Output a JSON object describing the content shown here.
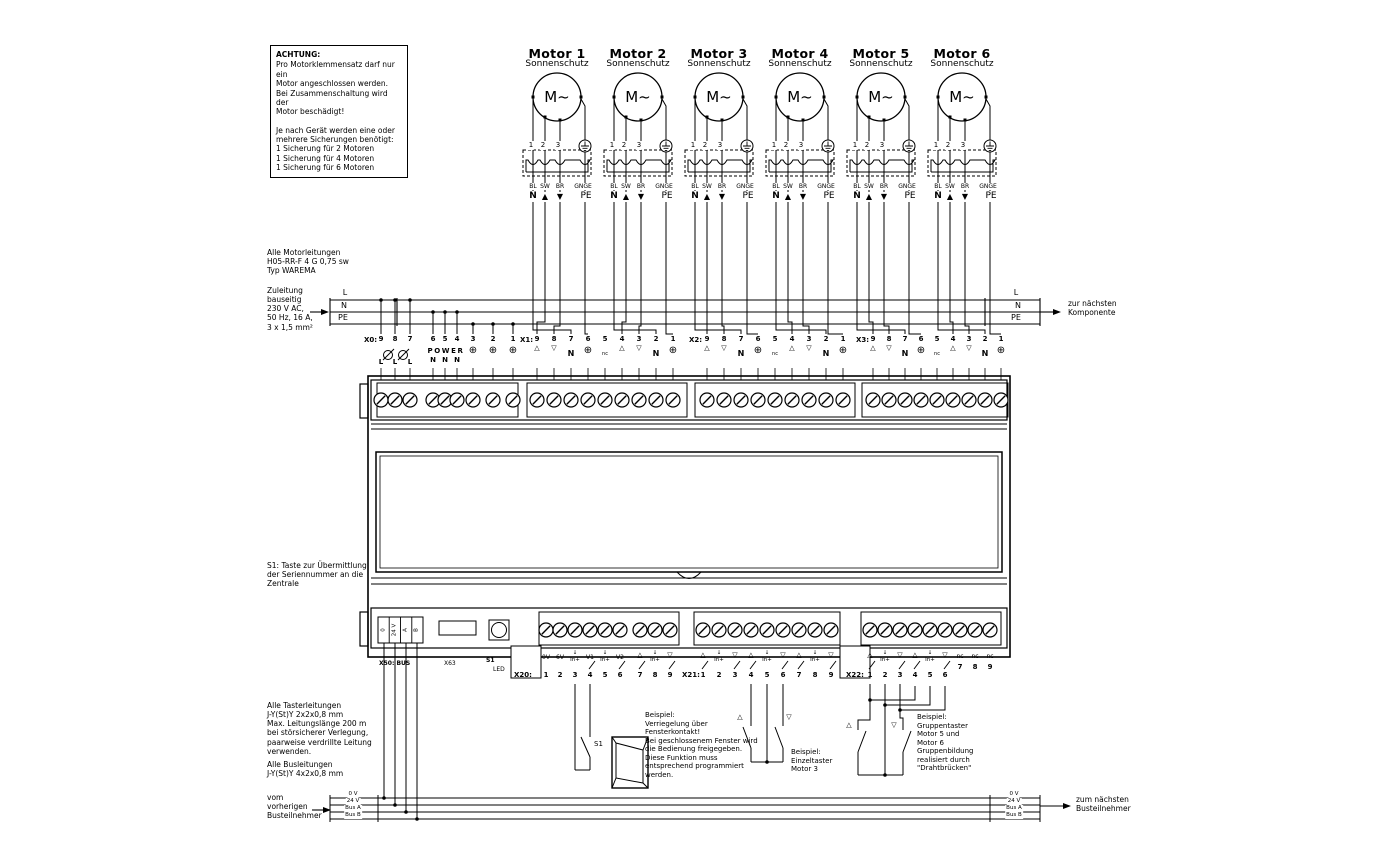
{
  "warning": {
    "title": "ACHTUNG:",
    "body1": "Pro Motorklemmensatz darf nur ein\nMotor angeschlossen werden.\nBei Zusammenschaltung wird der\nMotor beschädigt!",
    "body2": "Je nach Gerät werden eine oder\nmehrere Sicherungen benötigt:\n1 Sicherung für 2 Motoren\n1 Sicherung für 4 Motoren\n1 Sicherung für 6 Motoren"
  },
  "motors": [
    {
      "name": "Motor 1",
      "subtitle": "Sonnenschutz",
      "symbol": "M~"
    },
    {
      "name": "Motor 2",
      "subtitle": "Sonnenschutz",
      "symbol": "M~"
    },
    {
      "name": "Motor 3",
      "subtitle": "Sonnenschutz",
      "symbol": "M~"
    },
    {
      "name": "Motor 4",
      "subtitle": "Sonnenschutz",
      "symbol": "M~"
    },
    {
      "name": "Motor 5",
      "subtitle": "Sonnenschutz",
      "symbol": "M~"
    },
    {
      "name": "Motor 6",
      "subtitle": "Sonnenschutz",
      "symbol": "M~"
    }
  ],
  "motor_terminal": {
    "t1": "1",
    "t2": "2",
    "t3": "3",
    "colors": [
      "BL",
      "SW",
      "BR"
    ],
    "pe_color": "GNGE",
    "n": "N",
    "up": "▲",
    "down": "▼",
    "pe": "PE"
  },
  "notes": {
    "motor_cables": "Alle Motorleitungen\nH05-RR-F 4 G 0,75 sw\nTyp WAREMA",
    "supply": "Zuleitung\nbauseitig\n230 V AC,\n50 Hz, 16 A,\n3 x 1,5 mm²",
    "s1_note": "S1: Taste zur Übermittlung\nder Seriennummer an die\nZentrale",
    "taster_cables": "Alle Tasterleitungen\nJ-Y(St)Y 2x2x0,8 mm\nMax. Leitungslänge 200 m\nbei störsicherer Verlegung,\npaarweise verdrillte Leitung\nverwenden.",
    "bus_cables": "Alle Busleitungen\nJ-Y(St)Y 4x2x0,8 mm",
    "from_prev": "vom\nvorherigen\nBusteilnehmer",
    "next_component": "zur nächsten\nKomponente",
    "next_bus": "zum nächsten\nBusteilnehmer"
  },
  "power_bus": {
    "l": "L",
    "n": "N",
    "pe": "PE"
  },
  "data_bus": {
    "labels": [
      "0 V",
      "24 V",
      "Bus A",
      "Bus B"
    ]
  },
  "device": {
    "x0": {
      "label": "X0:",
      "nums": [
        "9",
        "8",
        "7",
        "6",
        "5",
        "4",
        "3",
        "2",
        "1"
      ],
      "l": "L",
      "power": "POWER",
      "n": "N",
      "pe": "⊕"
    },
    "x1": {
      "label": "X1:",
      "nums": [
        "9",
        "8",
        "7",
        "6",
        "5",
        "4",
        "3",
        "2",
        "1"
      ],
      "sym": [
        "△",
        "▽",
        "N",
        "⊕",
        "nc",
        "△",
        "▽",
        "N",
        "⊕"
      ]
    },
    "x2": {
      "label": "X2:",
      "nums": [
        "9",
        "8",
        "7",
        "6",
        "5",
        "4",
        "3",
        "2",
        "1"
      ],
      "sym": [
        "△",
        "▽",
        "N",
        "⊕",
        "nc",
        "△",
        "▽",
        "N",
        "⊕"
      ]
    },
    "x3": {
      "label": "X3:",
      "nums": [
        "9",
        "8",
        "7",
        "6",
        "5",
        "4",
        "3",
        "2",
        "1"
      ],
      "sym": [
        "△",
        "▽",
        "N",
        "⊕",
        "nc",
        "△",
        "▽",
        "N",
        "⊕"
      ]
    },
    "x50": {
      "label": "X50: BUS",
      "cells": [
        "0",
        "24 V",
        "A",
        "B"
      ]
    },
    "x63": {
      "label": "X63"
    },
    "s1": {
      "label": "S1",
      "led": "LED"
    },
    "x20": {
      "label": "X20:",
      "nums": [
        "1",
        "2",
        "3",
        "4",
        "5",
        "6",
        "7",
        "8",
        "9"
      ],
      "sym": [
        "0V",
        "6V",
        "↓\nIn+",
        "V1",
        "↓\nIn+",
        "V2",
        "△",
        "↓\nIn+",
        "▽"
      ]
    },
    "x21": {
      "label": "X21:",
      "nums": [
        "1",
        "2",
        "3",
        "4",
        "5",
        "6",
        "7",
        "8",
        "9"
      ],
      "sym": [
        "△",
        "↓\nIn+",
        "▽",
        "△",
        "↓\nIn+",
        "▽",
        "△",
        "↓\nIn+",
        "▽"
      ]
    },
    "x22": {
      "label": "X22:",
      "nums": [
        "1",
        "2",
        "3",
        "4",
        "5",
        "6",
        "7",
        "8",
        "9"
      ],
      "sym": [
        "△",
        "↓\nIn+",
        "▽",
        "△",
        "↓\nIn+",
        "▽",
        "nc",
        "nc",
        "nc"
      ]
    }
  },
  "examples": {
    "window_text": "Beispiel:\nVerriegelung über\nFensterkontakt!\nBei geschlossenem Fenster wird\ndie Bedienung freigegeben.\nDiese Funktion muss\nentsprechend programmiert\nwerden.",
    "window_switch": "S1",
    "single_text": "Beispiel:\nEinzeltaster\nMotor 3",
    "group_text": "Beispiel:\nGruppentaster\nMotor 5 und\nMotor 6\nGruppenbildung\nrealisiert durch\n\"Drahtbrücken\"",
    "single_up": "△",
    "single_down": "▽",
    "group_up": "△",
    "group_down": "▽"
  }
}
